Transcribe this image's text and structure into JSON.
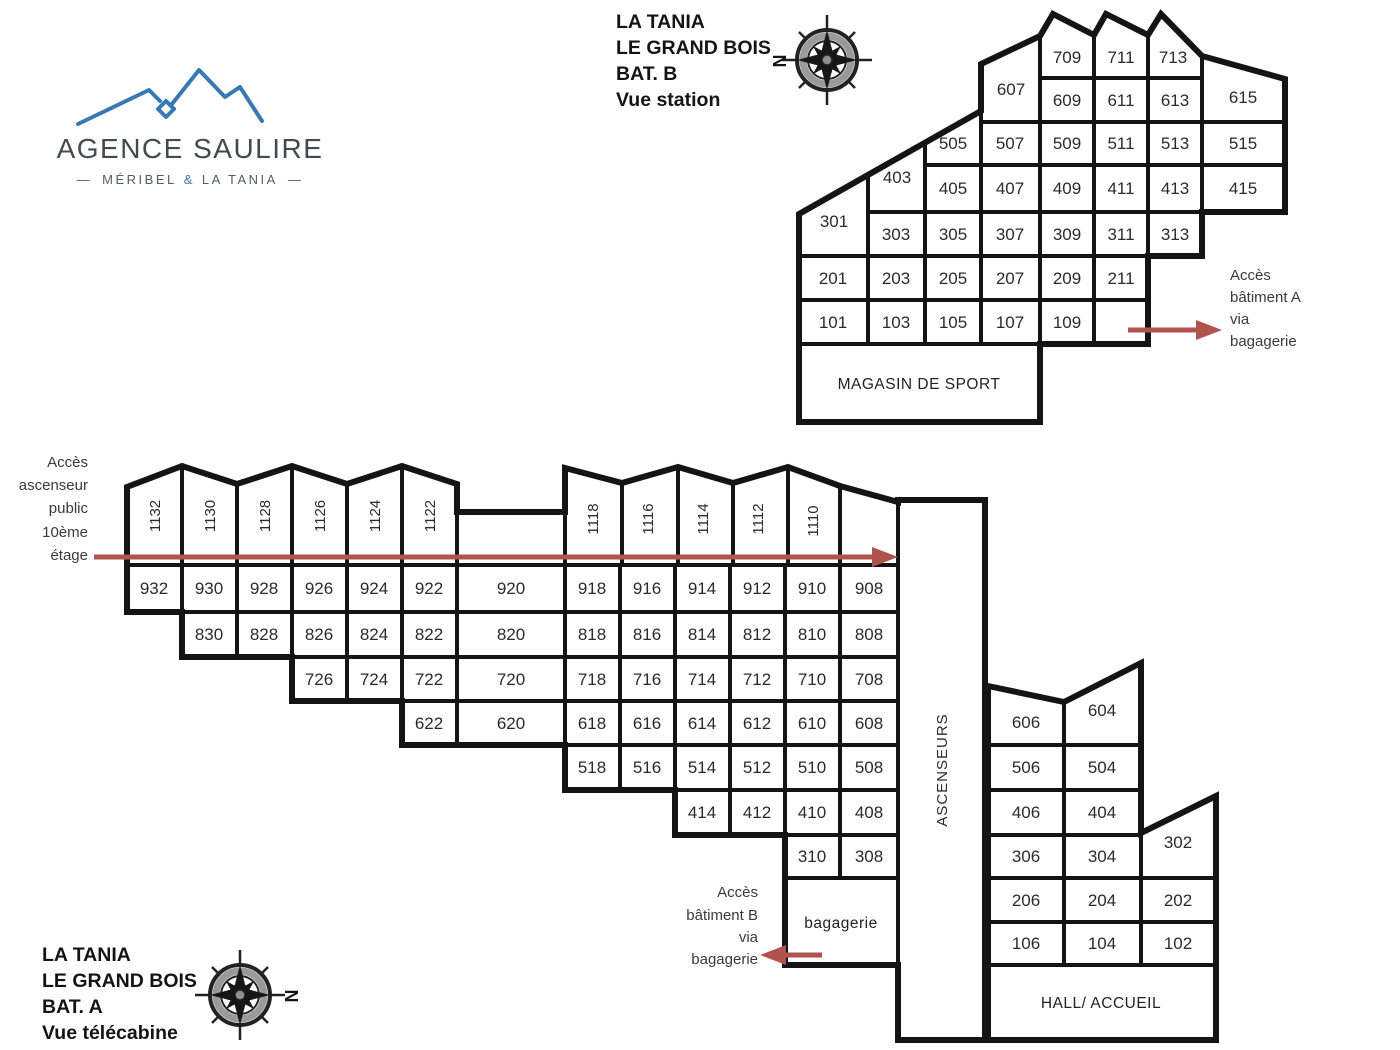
{
  "logo": {
    "name": "AGENCE SAULIRE",
    "dash_left": "—",
    "part1": "MÉRIBEL",
    "amp": "&",
    "part2": "LA TANIA",
    "dash_right": "—"
  },
  "titles": {
    "b": {
      "l1": "LA TANIA",
      "l2": "LE GRAND BOIS",
      "l3": "BAT. B",
      "l4": "Vue station"
    },
    "a": {
      "l1": "LA TANIA",
      "l2": "LE GRAND BOIS",
      "l3": "BAT. A",
      "l4": "Vue télécabine"
    }
  },
  "compass": {
    "letter": "N"
  },
  "annotations": {
    "acces_a": {
      "l1": "Accès",
      "l2": "bâtiment A",
      "l3": "via",
      "l4": "bagagerie"
    },
    "acces_b": {
      "l1": "Accès",
      "l2": "bâtiment B",
      "l3": "via",
      "l4": "bagagerie"
    },
    "acces_ascenseur": {
      "l1": "Accès",
      "l2": "ascenseur",
      "l3": "public",
      "l4": "10ème",
      "l5": "étage"
    }
  },
  "colors": {
    "arrow": "#b0534f",
    "wall": "#141414",
    "logo_blue": "#3878b4"
  },
  "b": {
    "u709": "709",
    "u711": "711",
    "u713": "713",
    "u607": "607",
    "u609": "609",
    "u611": "611",
    "u613": "613",
    "u615": "615",
    "u505": "505",
    "u507": "507",
    "u509": "509",
    "u511": "511",
    "u513": "513",
    "u515": "515",
    "u403": "403",
    "u405": "405",
    "u407": "407",
    "u409": "409",
    "u411": "411",
    "u413": "413",
    "u415": "415",
    "u301": "301",
    "u303": "303",
    "u305": "305",
    "u307": "307",
    "u309": "309",
    "u311": "311",
    "u313": "313",
    "u201": "201",
    "u203": "203",
    "u205": "205",
    "u207": "207",
    "u209": "209",
    "u211": "211",
    "u101": "101",
    "u103": "103",
    "u105": "105",
    "u107": "107",
    "u109": "109",
    "magasin": "MAGASIN DE SPORT"
  },
  "a": {
    "u1132": "1132",
    "u1130": "1130",
    "u1128": "1128",
    "u1126": "1126",
    "u1124": "1124",
    "u1122": "1122",
    "u1118": "1118",
    "u1116": "1116",
    "u1114": "1114",
    "u1112": "1112",
    "u1110": "1110",
    "u932": "932",
    "u930": "930",
    "u928": "928",
    "u926": "926",
    "u924": "924",
    "u922": "922",
    "u920": "920",
    "u918": "918",
    "u916": "916",
    "u914": "914",
    "u912": "912",
    "u910": "910",
    "u908": "908",
    "u830": "830",
    "u828": "828",
    "u826": "826",
    "u824": "824",
    "u822": "822",
    "u820": "820",
    "u818": "818",
    "u816": "816",
    "u814": "814",
    "u812": "812",
    "u810": "810",
    "u808": "808",
    "u726": "726",
    "u724": "724",
    "u722": "722",
    "u720": "720",
    "u718": "718",
    "u716": "716",
    "u714": "714",
    "u712": "712",
    "u710": "710",
    "u708": "708",
    "u622": "622",
    "u620": "620",
    "u618": "618",
    "u616": "616",
    "u614": "614",
    "u612": "612",
    "u610": "610",
    "u608": "608",
    "u518": "518",
    "u516": "516",
    "u514": "514",
    "u512": "512",
    "u510": "510",
    "u508": "508",
    "u414": "414",
    "u412": "412",
    "u410": "410",
    "u408": "408",
    "u310": "310",
    "u308": "308",
    "u606": "606",
    "u604": "604",
    "u506": "506",
    "u504": "504",
    "u406": "406",
    "u404": "404",
    "u306": "306",
    "u304": "304",
    "u302": "302",
    "u206": "206",
    "u204": "204",
    "u202": "202",
    "u106": "106",
    "u104": "104",
    "u102": "102",
    "ascenseurs": "ASCENSEURS",
    "bagagerie": "bagagerie",
    "hall": "HALL/ ACCUEIL"
  }
}
